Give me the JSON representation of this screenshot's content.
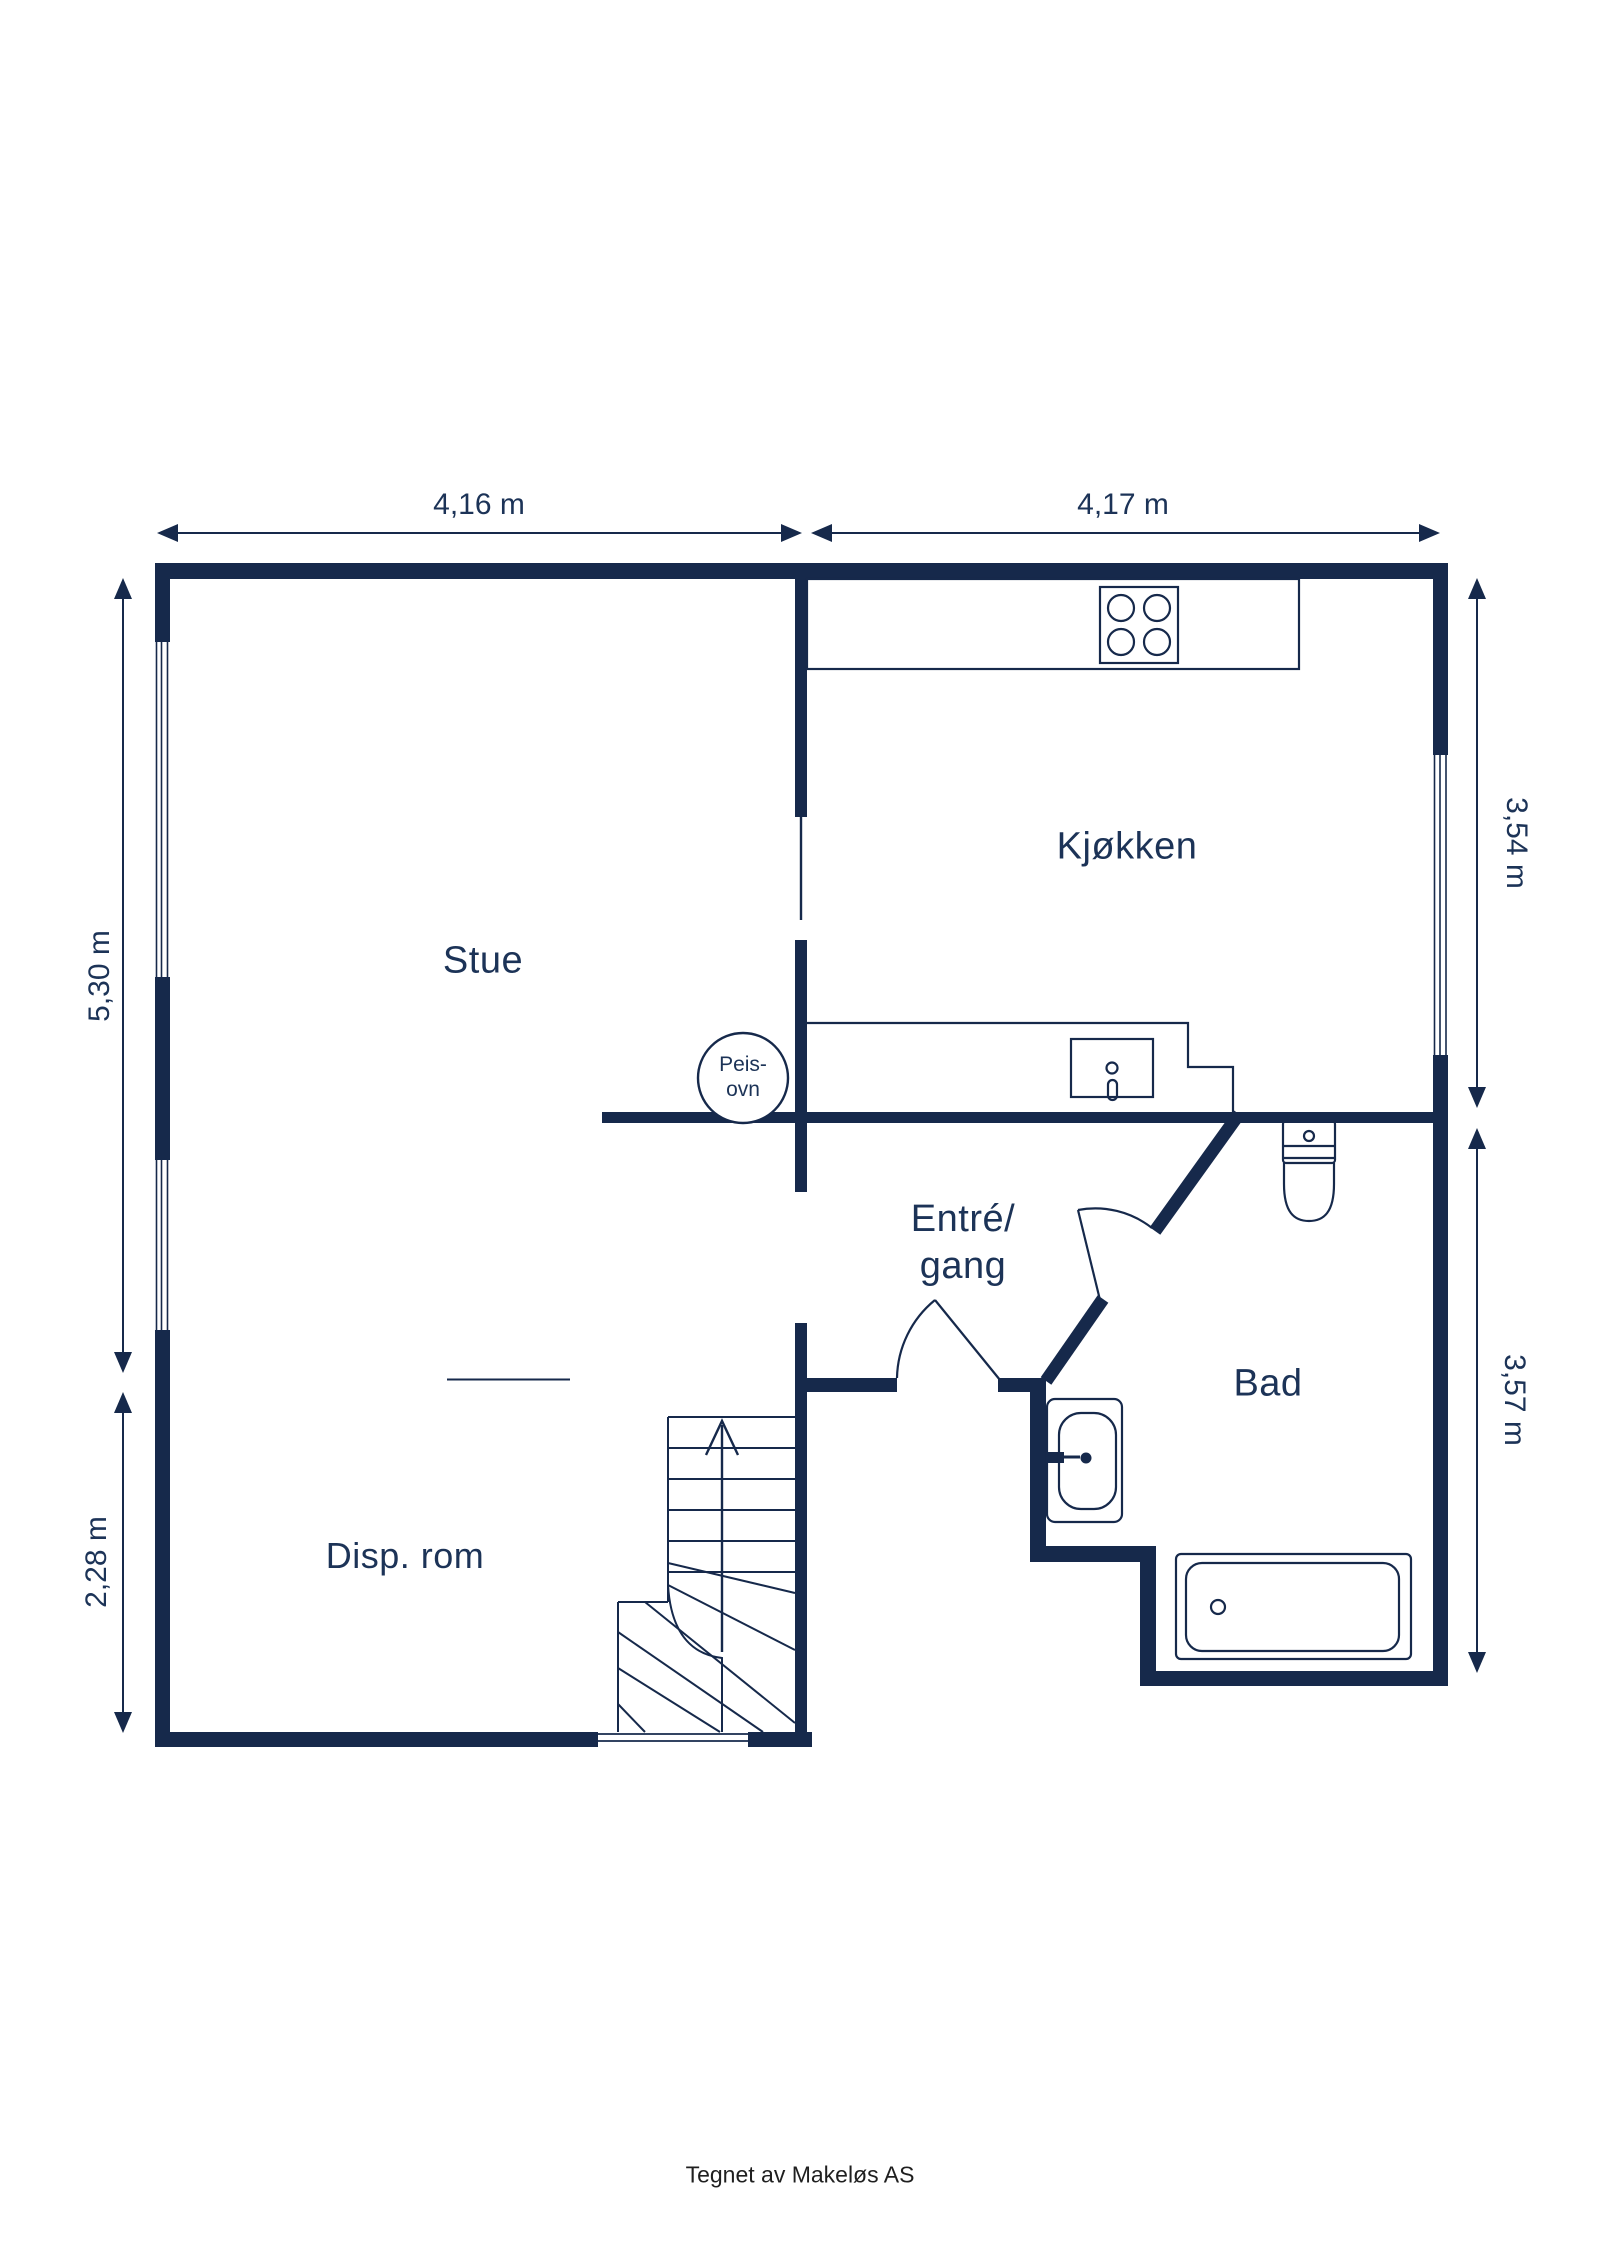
{
  "rooms": {
    "stue": "Stue",
    "kjokken": "Kjøkken",
    "entre_line1": "Entré/",
    "entre_line2": "gang",
    "bad": "Bad",
    "disp_rom": "Disp. rom"
  },
  "fixtures": {
    "fireplace_line1": "Peis-",
    "fireplace_line2": "ovn"
  },
  "dimensions": {
    "top_left": "4,16 m",
    "top_right": "4,17 m",
    "left_upper": "5,30 m",
    "left_lower": "2,28 m",
    "right_upper": "3,54 m",
    "right_lower": "3,57 m"
  },
  "footer": {
    "credit": "Tegnet av Makeløs AS"
  },
  "colors": {
    "wall": "#16294B",
    "text": "#1C3357",
    "footer_text": "#1F1F1F",
    "background": "#FFFFFF"
  }
}
